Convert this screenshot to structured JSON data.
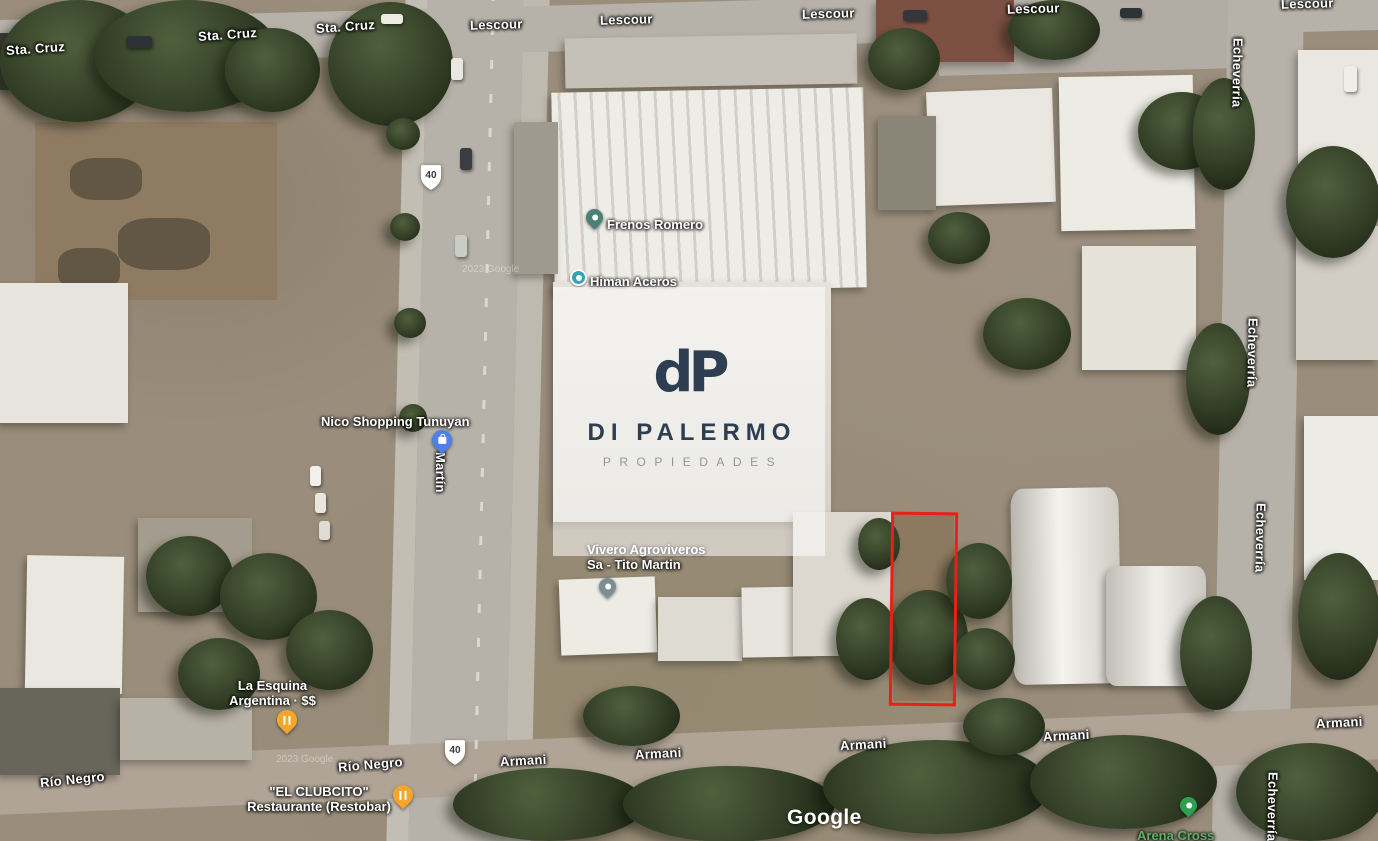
{
  "attribution": {
    "google_logo": "Google",
    "tile_credit": "2023 Google"
  },
  "route_shield": {
    "number": "40"
  },
  "streets": {
    "sta_cruz": "Sta. Cruz",
    "lescour": "Lescour",
    "echeverria": "Echeverría",
    "martin": "Martín",
    "rio_negro": "Río Negro",
    "armani": "Armani"
  },
  "pois": {
    "frenos_romero": {
      "label": "Frenos Romero"
    },
    "himan_aceros": {
      "label": "Himan Aceros"
    },
    "nico_shopping": {
      "label": "Nico Shopping Tunuyan"
    },
    "vivero": {
      "line1": "Vivero Agroviveros",
      "line2": "Sa - Tito Martin"
    },
    "la_esquina": {
      "line1": "La Esquina",
      "line2": "Argentina · $$"
    },
    "el_clubcito": {
      "line1": "\"EL CLUBCITO\"",
      "line2": "Restaurante (Restobar)"
    },
    "arena_cross": {
      "label": "Arena Cross"
    }
  },
  "watermark": {
    "monogram": "dP",
    "title": "DI PALERMO",
    "subtitle": "PROPIEDADES"
  },
  "colors": {
    "red_outline": "#e7201a",
    "brand_navy": "#2d3e50",
    "brand_gray": "#90969d",
    "green_label": "#5cb266",
    "dot_teal": "#35a3b2",
    "pin_teal": "#4c8077",
    "pin_blue": "#4e80e8",
    "pin_slate": "#7d8d98",
    "pin_orange": "#f4a62a",
    "pin_green": "#2e9e4f"
  }
}
